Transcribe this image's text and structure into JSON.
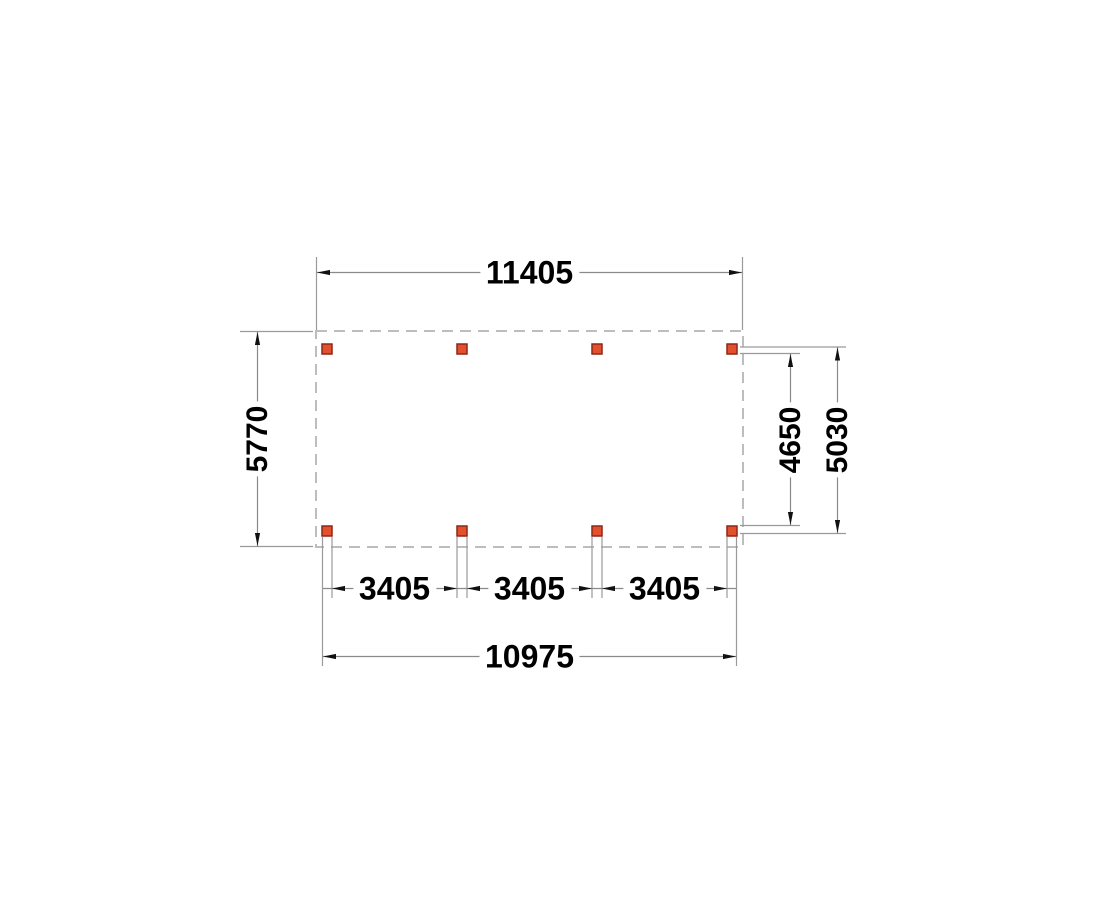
{
  "drawing": {
    "type": "top-view-floor-plan",
    "dimensions": {
      "top_width": "11405",
      "left_height": "5770",
      "right_inner_height": "4650",
      "right_outer_height": "5030",
      "post_spacing": [
        "3405",
        "3405",
        "3405"
      ],
      "bottom_width": "10975"
    },
    "posts": {
      "count": 8,
      "rows": 2,
      "columns": 4
    },
    "colors": {
      "background": "#ffffff",
      "outline": "#bdbdbd",
      "line": "#8a8a8a",
      "ext_line": "#9a9a9a",
      "arrow": "#111111",
      "post_fill": "#e2502e",
      "post_stroke": "#8f2717",
      "label_text": "#000000"
    }
  }
}
